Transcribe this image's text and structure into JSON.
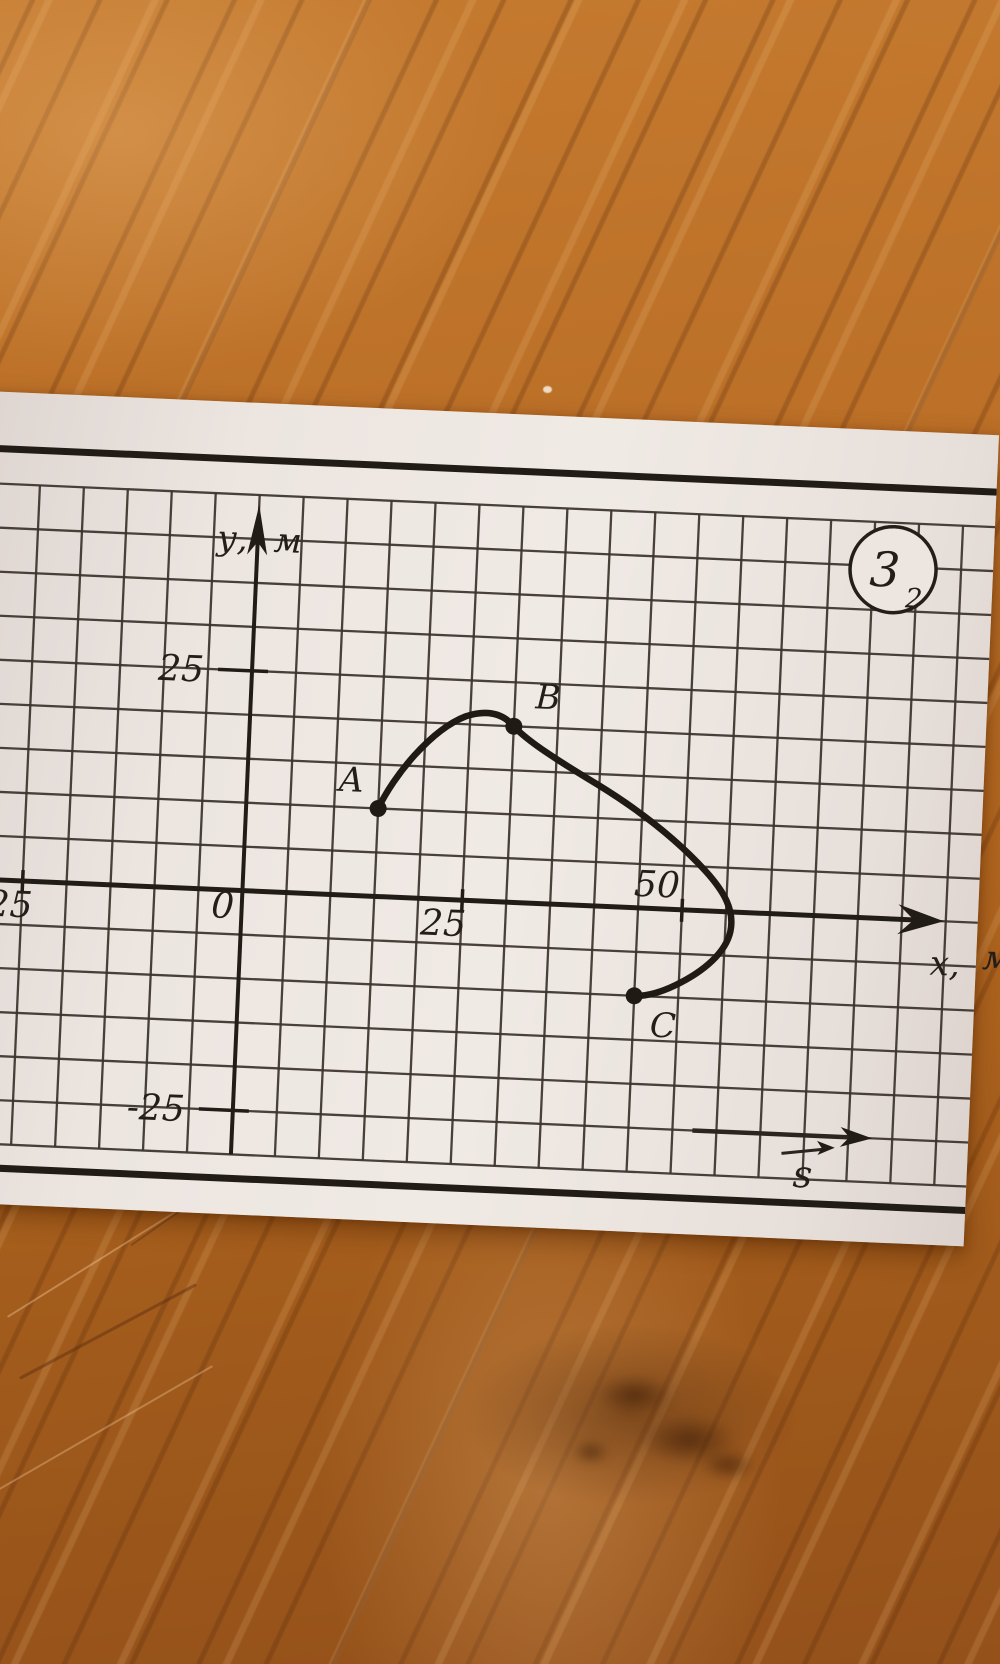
{
  "scene": {
    "background": "wooden-table-surface"
  },
  "card": {
    "badge": {
      "number": "3",
      "subscript": "2"
    },
    "y_axis": {
      "label_left": "у,",
      "label_right": "м",
      "tick_top": "25",
      "tick_bottom": "-25"
    },
    "x_axis": {
      "label_left": "х,",
      "label_right": "м",
      "tick_left": "-25",
      "tick_mid": "25",
      "tick_right": "50",
      "origin": "0"
    },
    "vector_s_label": "s"
  },
  "chart_data": {
    "type": "line",
    "xlabel": "х, м",
    "ylabel": "у, м",
    "grid_step_m": 5,
    "x_ticks": [
      -25,
      0,
      25,
      50
    ],
    "y_ticks": [
      -25,
      0,
      25
    ],
    "xlim": [
      -30,
      75
    ],
    "ylim": [
      -30,
      45
    ],
    "points": [
      {
        "label": "A",
        "x": 15,
        "y": 10
      },
      {
        "label": "B",
        "x": 30,
        "y": 20
      },
      {
        "label": "C",
        "x": 45,
        "y": -10
      }
    ],
    "curve": {
      "start": [
        15,
        10
      ],
      "bezier_segments": [
        [
          [
            16.6,
            13.8
          ],
          [
            20.6,
            19.2
          ],
          [
            24.5,
            20.9
          ]
        ],
        [
          [
            26.9,
            21.8
          ],
          [
            28.7,
            21.4
          ],
          [
            30,
            20
          ]
        ],
        [
          [
            31.7,
            18.3
          ],
          [
            35.4,
            16.2
          ],
          [
            39.8,
            13.8
          ]
        ],
        [
          [
            44.3,
            11.3
          ],
          [
            48.8,
            8.2
          ],
          [
            52.4,
            4.6
          ]
        ],
        [
          [
            54.7,
            2.3
          ],
          [
            56.0,
            0.2
          ],
          [
            55.6,
            -2.2
          ]
        ],
        [
          [
            55.2,
            -4.6
          ],
          [
            52.8,
            -6.9
          ],
          [
            49.6,
            -8.6
          ]
        ],
        [
          [
            48.1,
            -9.4
          ],
          [
            46.4,
            -10
          ],
          [
            45,
            -10
          ]
        ]
      ]
    }
  }
}
